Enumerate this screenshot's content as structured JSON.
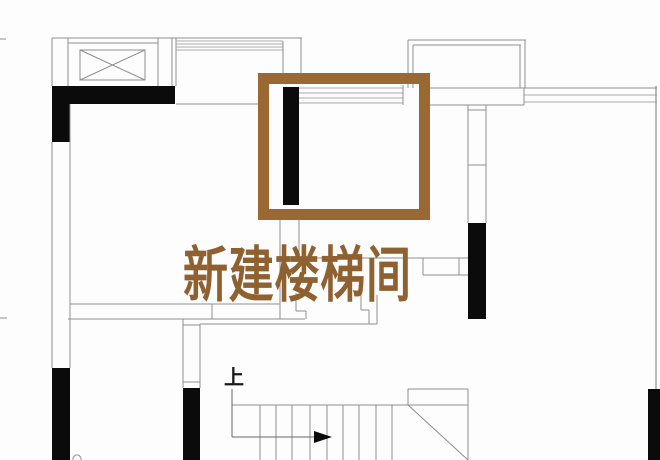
{
  "floor_plan": {
    "annotation_label": "新建楼梯间",
    "stair_direction_label": "上",
    "colors": {
      "background": "#fdfdfd",
      "wall_line": "#8e8e8e",
      "light_line": "#ababab",
      "wall_fill": "#0b0b0b",
      "highlight_frame": "#9a6833",
      "annotation_text": "#8f6130",
      "stair_label": "#1a1a1a"
    }
  }
}
